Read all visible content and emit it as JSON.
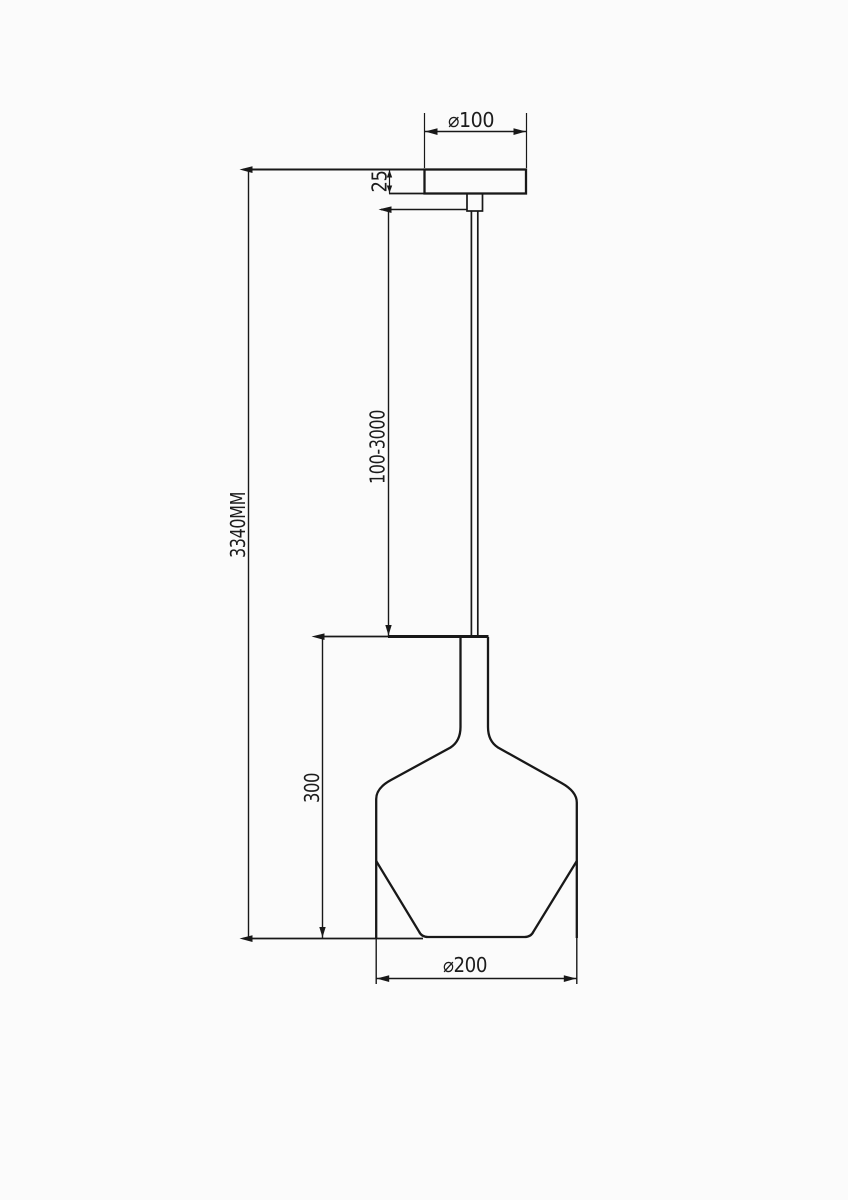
{
  "page": {
    "background": "#fbfbfb",
    "ink": "#181818"
  },
  "drawing": {
    "type": "technical-dimension-drawing",
    "subject": "pendant-lamp",
    "labels": {
      "canopy_diameter": "⌀100",
      "canopy_thickness": "25",
      "suspension_length_range": "100-3000",
      "overall_height": "3340MM",
      "shade_height": "300",
      "shade_diameter": "⌀200"
    }
  }
}
